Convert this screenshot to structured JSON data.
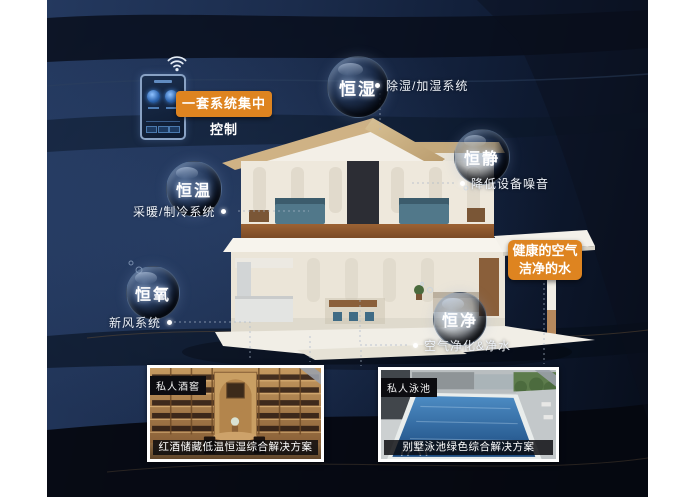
{
  "infographic": {
    "control_panel_label": "一套系统集中控制",
    "bubbles": [
      {
        "label": "恒湿",
        "desc": "除湿/加湿系统"
      },
      {
        "label": "恒静",
        "desc": "降低设备噪音"
      },
      {
        "label": "恒温",
        "desc": "采暖/制冷系统"
      },
      {
        "label": "恒氧",
        "desc": "新风系统"
      },
      {
        "label": "恒净",
        "desc": "空气净化&净水"
      }
    ],
    "highlight_box": {
      "line1": "健康的空气",
      "line2": "洁净的水"
    },
    "cards": [
      {
        "tag": "私人酒窖",
        "caption": "红酒储藏低温恒湿综合解决方案"
      },
      {
        "tag": "私人泳池",
        "caption": "别墅泳池绿色综合解决方案"
      }
    ],
    "colors": {
      "accent_orange": "#DE8420",
      "background_navy": "#1C2E4E",
      "label_text": "#FFFFFF"
    }
  }
}
